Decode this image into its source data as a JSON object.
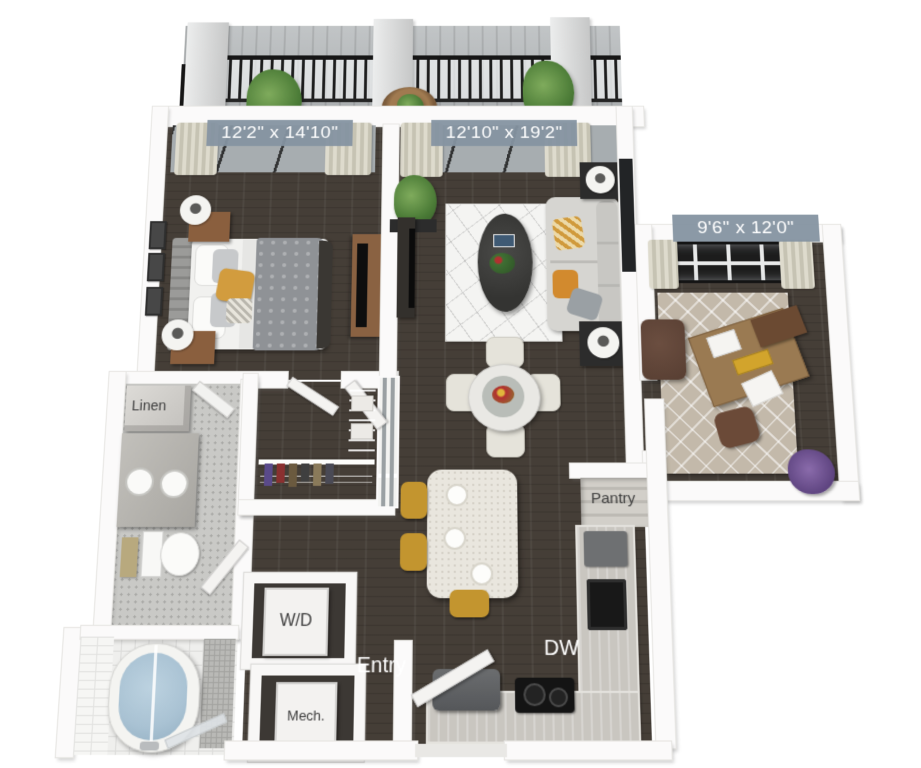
{
  "floorplan": {
    "rooms": [
      {
        "name": "bedroom",
        "dimensions": "12'2\" x 14'10\""
      },
      {
        "name": "living-dining",
        "dimensions": "12'10\" x 19'2\""
      },
      {
        "name": "den",
        "dimensions": "9'6\" x 12'0\""
      }
    ],
    "labels": {
      "linen": "Linen",
      "pantry": "Pantry",
      "washer_dryer": "W/D",
      "mechanical": "Mech.",
      "entry": "Entry",
      "dishwasher": "DW"
    },
    "colors": {
      "background": "#ffffff",
      "dimension_label_bg": "#8593a1",
      "dimension_label_text": "#ffffff",
      "wall": "#fbfafa",
      "wood_floor": "#453e37",
      "bathroom_floor": "#c9c9c6",
      "balcony_deck": "#b4b8ba",
      "railing": "#1d1d1d",
      "sofa": "#d6d5d1",
      "accent_mustard": "#d09a3c",
      "tub_water": "#a9c2d3",
      "living_rug": "#f4f4f2",
      "den_rug": "#c8beb0"
    }
  }
}
